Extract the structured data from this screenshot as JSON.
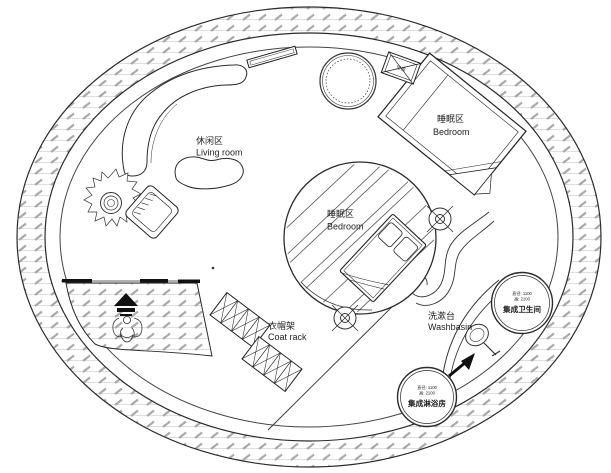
{
  "plan": {
    "areas": {
      "living_room": {
        "label_cn": "休闲区",
        "label_en": "Living room"
      },
      "bedroom_upper": {
        "label_cn": "睡眠区",
        "label_en": "Bedroom"
      },
      "bedroom_center": {
        "label_cn": "睡眠区",
        "label_en": "Bedroom"
      },
      "coat_rack": {
        "label_cn": "衣帽架",
        "label_en": "Coat rack"
      },
      "washbasin": {
        "label_cn": "洗漱台",
        "label_en": "Washbasin"
      },
      "integrated_bathroom": {
        "label_cn": "集成卫生间",
        "spec_diameter": "直径: 1100",
        "spec_height": "高: 2100"
      },
      "integrated_shower": {
        "label_cn": "集成淋浴房",
        "spec_diameter": "直径: 1100",
        "spec_height": "高: 2100"
      },
      "air_conditioner": {
        "label_cn": "空调"
      }
    },
    "icons": {
      "entrance_arrow": "solid-triangle-up-with-bars",
      "column_marker": "crosshair-circle",
      "ac_unit": "crossed-box",
      "washbasin_sink": "round-sink-with-faucet",
      "flow_arrow": "tapered-arrow-northeast"
    },
    "colors": {
      "background": "#ffffff",
      "line": "#2b2b2b",
      "wall_hatch_dash": "#a9a9a9",
      "wall_hatch_line": "#cfcfcf",
      "symbol_fill": "#111111"
    }
  }
}
